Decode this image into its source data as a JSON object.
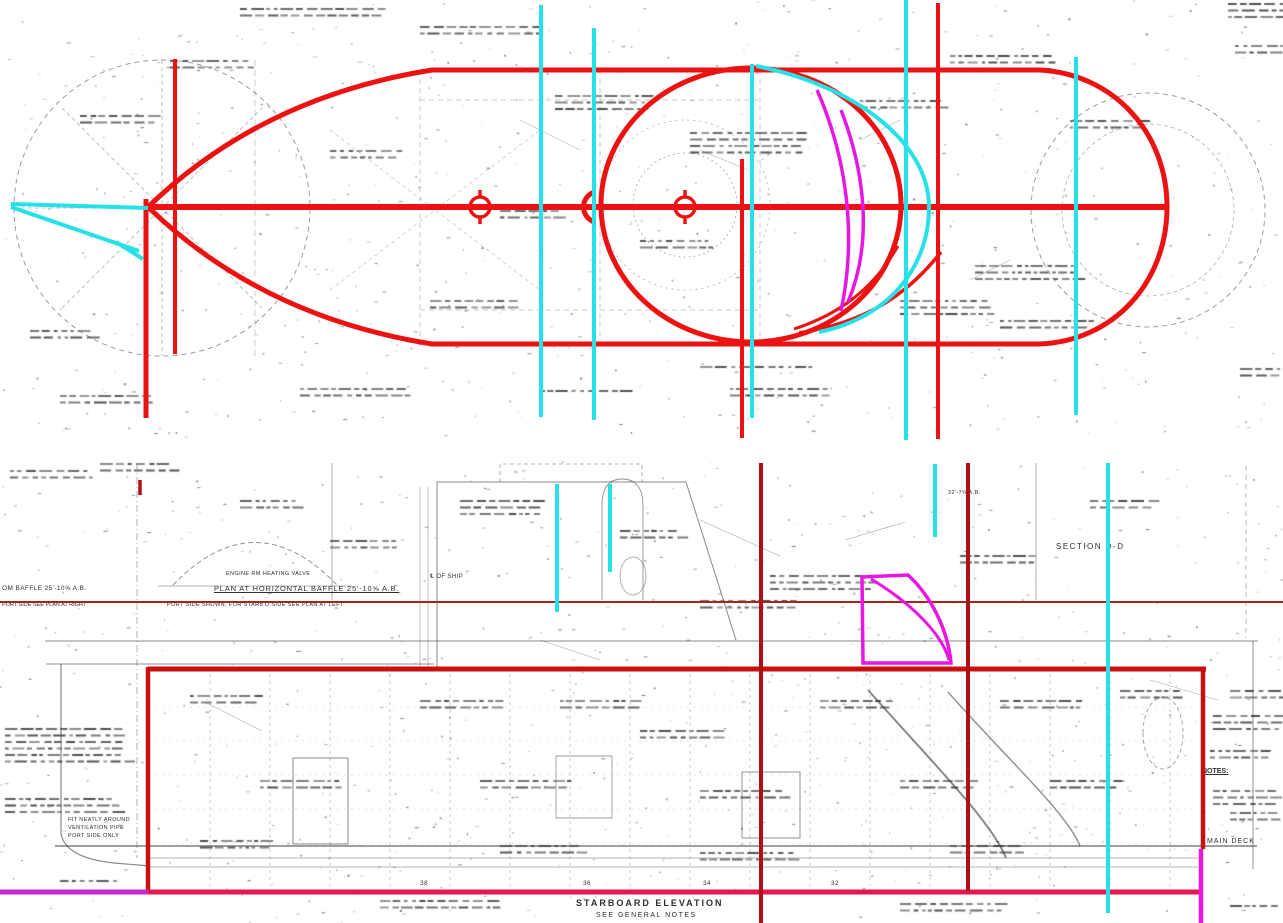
{
  "colors": {
    "red": "#ec1212",
    "box_red": "#c9100f",
    "dark_red": "#ad1115",
    "thin_red": "#a8221e",
    "crimson": "#e9164b",
    "magenta": "#e716e2",
    "purple": "#c22bd0",
    "cyan": "#26e2e8",
    "ink": "#3a3a3a"
  },
  "annotations": {
    "plan_title": {
      "text": "PLAN AT HORIZONTAL BAFFLE 25'-10⅝ A.B."
    },
    "plan_subtitle": {
      "text": "PORT SIDE SHOWN, FOR STARB'D SIDE SEE PLAN AT LEFT"
    },
    "left_baffle": {
      "text": "OM BAFFLE 25'-10⅝ A.B."
    },
    "left_port_note": {
      "text": "PORT SIDE SEE PLAN AT RIGHT"
    },
    "section_label": {
      "text": "SECTION D-D"
    },
    "elevation_title": {
      "text": "STARBOARD ELEVATION"
    },
    "elevation_subtitle": {
      "text": "SEE GENERAL NOTES"
    },
    "notes_heading": {
      "text": "NOTES:"
    },
    "main_deck": {
      "text": "MAIN DECK"
    },
    "minor": [
      {
        "text": "℄ OF SHIP",
        "x": 430,
        "y": 574,
        "s": 6
      },
      {
        "text": "ENGINE RM HEATING VALVE",
        "x": 226,
        "y": 572,
        "s": 5.5
      },
      {
        "text": "32'-7⅝ A.B.",
        "x": 948,
        "y": 491,
        "s": 5.5
      },
      {
        "text": "FIT NEATLY AROUND",
        "x": 68,
        "y": 818,
        "s": 5.5
      },
      {
        "text": "VENTILATION PIPE",
        "x": 68,
        "y": 826,
        "s": 5.5
      },
      {
        "text": "PORT SIDE ONLY",
        "x": 68,
        "y": 834,
        "s": 5.5
      },
      {
        "text": "38",
        "x": 420,
        "y": 881,
        "s": 6.5
      },
      {
        "text": "36",
        "x": 583,
        "y": 881,
        "s": 6.5
      },
      {
        "text": "34",
        "x": 703,
        "y": 881,
        "s": 6.5
      },
      {
        "text": "32",
        "x": 831,
        "y": 881,
        "s": 6.5
      }
    ]
  },
  "overlay_lines": [
    {
      "name": "plan-hull-outline",
      "color": "red",
      "w": 5,
      "d": "M148,207 Q262,97 432,70 L1040,70 C1113,74 1167,132 1167,207 C1167,283 1113,341 1040,344 L432,344 Q262,317 148,207"
    },
    {
      "name": "plan-centerline",
      "color": "red",
      "w": 6,
      "d": "M148,207 H1167"
    },
    {
      "name": "plan-vertical-bow-1",
      "color": "red",
      "w": 5,
      "d": "M146,199 V418"
    },
    {
      "name": "plan-vertical-bow-2",
      "color": "red",
      "w": 4,
      "d": "M175,59 V354"
    },
    {
      "name": "plan-vertical-mid",
      "color": "red",
      "w": 4,
      "d": "M742,159 V438"
    },
    {
      "name": "plan-vertical-aft",
      "color": "red",
      "w": 4,
      "d": "M938,3 V439"
    },
    {
      "name": "plan-large-circle",
      "color": "red",
      "w": 5,
      "d": "M601,205 a150,137 0 1,0 300,0 a150,137 0 1,0 -300,0"
    },
    {
      "name": "plan-center-marker-1",
      "color": "red",
      "w": 3.5,
      "d": "M470,207 a10,10 0 1,0 20,0 a10,10 0 1,0 -20,0 M464,207 h-9 M502,207 h9 M480,197 v-7 M480,217 v7"
    },
    {
      "name": "plan-center-marker-2",
      "color": "red",
      "w": 3.5,
      "d": "M675,207 a10,10 0 1,0 20,0 a10,10 0 1,0 -20,0 M669,207 h-9 M707,207 h9 M685,197 v-7 M685,217 v7"
    },
    {
      "name": "plan-arrow-marker",
      "color": "red",
      "w": 5,
      "d": "M594,192 C580,198 580,216 594,222"
    },
    {
      "name": "plan-stern-arc-a",
      "color": "red",
      "w": 3.5,
      "d": "M941,252 C905,298 862,323 799,333"
    },
    {
      "name": "plan-stern-arc-b",
      "color": "red",
      "w": 3,
      "d": "M898,246 C872,291 837,315 794,329"
    },
    {
      "name": "plan-magenta-curve-a",
      "color": "magenta",
      "w": 3.5,
      "d": "M817,90 C847,158 857,236 841,311"
    },
    {
      "name": "plan-magenta-curve-b",
      "color": "magenta",
      "w": 3.5,
      "d": "M841,110 C865,172 873,243 848,302"
    },
    {
      "name": "plan-cyan-arrow-top",
      "color": "cyan",
      "w": 4,
      "d": "M11,204 L148,208"
    },
    {
      "name": "plan-cyan-arrow-bottom",
      "color": "cyan",
      "w": 4,
      "d": "M11,207 L139,251"
    },
    {
      "name": "plan-cyan-tick",
      "color": "cyan",
      "w": 4,
      "d": "M116,242 L143,259"
    },
    {
      "name": "plan-cyan-stern-curve",
      "color": "cyan",
      "w": 4,
      "d": "M756,66 C850,84 929,140 929,207 C929,268 888,318 819,332"
    },
    {
      "name": "plan-cyan-station-1",
      "color": "cyan",
      "w": 4,
      "d": "M541,5 V417"
    },
    {
      "name": "plan-cyan-station-2",
      "color": "cyan",
      "w": 4,
      "d": "M594,28 V420"
    },
    {
      "name": "plan-cyan-station-3",
      "color": "cyan",
      "w": 4,
      "d": "M752,64 V418"
    },
    {
      "name": "plan-cyan-station-4",
      "color": "cyan",
      "w": 4,
      "d": "M906,0 V440"
    },
    {
      "name": "plan-cyan-station-5",
      "color": "cyan",
      "w": 4,
      "d": "M1076,57 V415"
    },
    {
      "name": "elev-baffle-line",
      "color": "thin_red",
      "w": 2,
      "d": "M0,602 H1283"
    },
    {
      "name": "elev-box-top",
      "color": "box_red",
      "w": 5,
      "d": "M148,669 H1206"
    },
    {
      "name": "elev-box-left",
      "color": "box_red",
      "w": 4.5,
      "d": "M148,667 V893"
    },
    {
      "name": "elev-box-right",
      "color": "box_red",
      "w": 4.5,
      "d": "M1203,669 V849"
    },
    {
      "name": "elev-bottom-crimson",
      "color": "crimson",
      "w": 5,
      "d": "M146,892 H1200"
    },
    {
      "name": "elev-bottom-purple",
      "color": "purple",
      "w": 5,
      "d": "M0,892 H148"
    },
    {
      "name": "elev-magenta-vertical",
      "color": "magenta",
      "w": 4.5,
      "d": "M1201,849 V923"
    },
    {
      "name": "elev-darkred-vertical-1",
      "color": "dark_red",
      "w": 4,
      "d": "M761,463 V923"
    },
    {
      "name": "elev-darkred-vertical-2",
      "color": "dark_red",
      "w": 4,
      "d": "M968,463 V891"
    },
    {
      "name": "elev-darkred-tick",
      "color": "dark_red",
      "w": 3.5,
      "d": "M140,480 V495"
    },
    {
      "name": "elev-magenta-sail",
      "color": "magenta",
      "w": 3.5,
      "d": "M862,577 L908,575 C932,597 948,631 951,663 L863,663 Z"
    },
    {
      "name": "elev-magenta-sail-inner",
      "color": "magenta",
      "w": 3,
      "d": "M871,579 C916,606 943,637 949,660"
    },
    {
      "name": "elev-cyan-station-1",
      "color": "cyan",
      "w": 4,
      "d": "M557,484 V612"
    },
    {
      "name": "elev-cyan-station-2",
      "color": "cyan",
      "w": 4,
      "d": "M610,484 V572"
    },
    {
      "name": "elev-cyan-station-3",
      "color": "cyan",
      "w": 4,
      "d": "M935,464 V537"
    },
    {
      "name": "elev-cyan-station-4",
      "color": "cyan",
      "w": 4,
      "d": "M1108,463 V913"
    }
  ]
}
